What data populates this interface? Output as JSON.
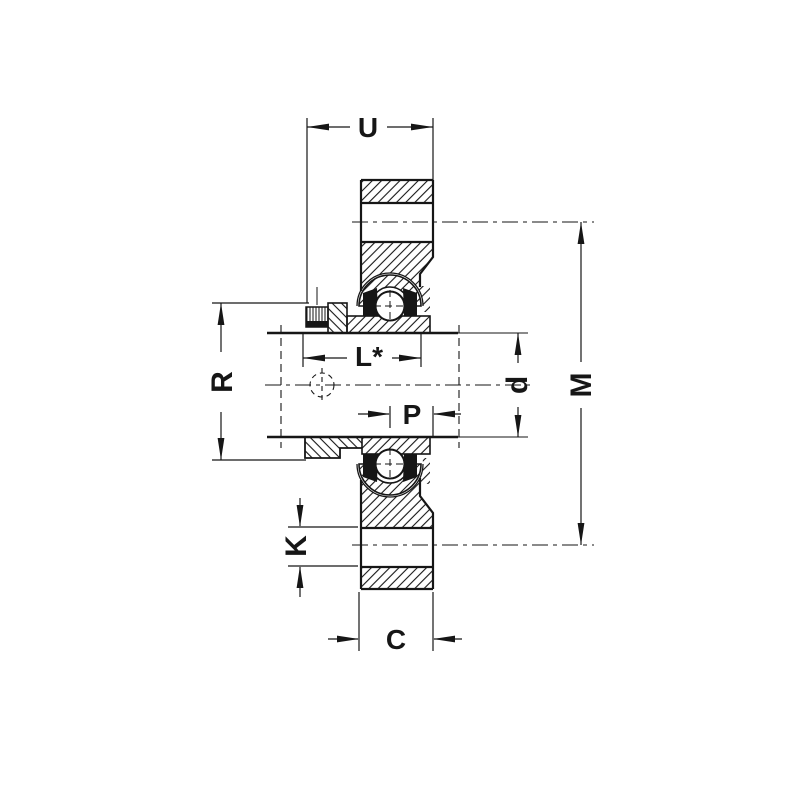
{
  "drawing": {
    "kind": "flanged-bearing-unit-cross-section",
    "colors": {
      "ink": "#161616",
      "paper": "#ffffff"
    },
    "dimension_labels": {
      "u": "U",
      "l": "L*",
      "r": "R",
      "d": "d",
      "m": "M",
      "p": "P",
      "k": "K",
      "c": "C"
    }
  }
}
